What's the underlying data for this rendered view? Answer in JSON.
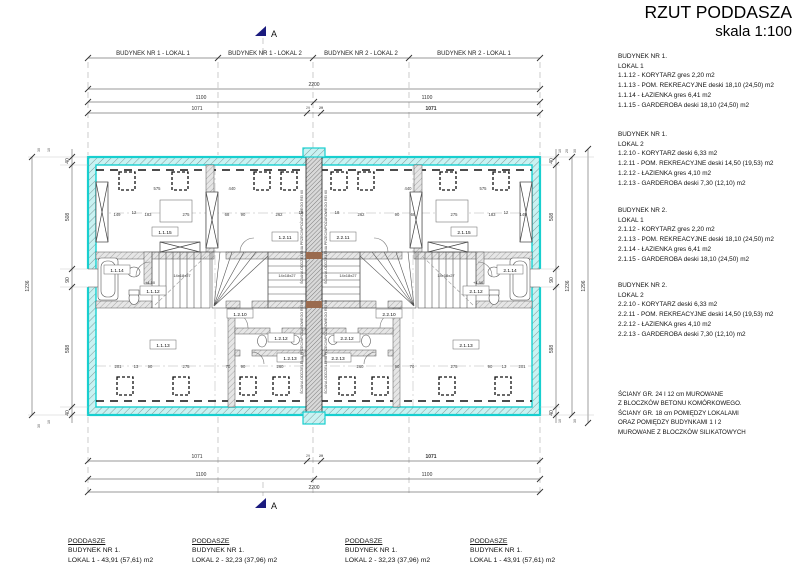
{
  "title": {
    "main": "RZUT PODDASZA",
    "scale": "skala 1:100"
  },
  "marker": {
    "letter": "A"
  },
  "axis": {
    "top_labels": [
      "BUDYNEK NR 1 - LOKAL 1",
      "BUDYNEK NR 1 - LOKAL 2",
      "BUDYNEK NR 2 - LOKAL 2",
      "BUDYNEK NR 2 - LOKAL 1"
    ],
    "total": "2200",
    "half": "1100",
    "segment": "1071",
    "gap": "29",
    "v_total": "1236",
    "v_outer": "1296",
    "v40": "40",
    "v508": "508",
    "v90": "90",
    "v598": "598",
    "s30": "30",
    "s10": "10",
    "s20": "20"
  },
  "plan": {
    "firewall": "ŚCIANA ODDZIELENIA PRZECIWPOŻAROWEGO REI 60",
    "stair": "14x18x27",
    "level": "+4,50",
    "rooms": [
      "1.1.15",
      "1.2.11",
      "1.1.14",
      "1.1.12",
      "1.1.13",
      "1.2.10",
      "1.2.12",
      "1.2.13",
      "2.2.11",
      "2.1.15",
      "2.1.14",
      "2.1.12",
      "2.1.13",
      "2.2.10",
      "2.2.12",
      "2.2.13"
    ],
    "nums": [
      "575",
      "440",
      "149",
      "12",
      "183",
      "275",
      "68",
      "90",
      "262",
      "18",
      "18",
      "262",
      "90",
      "68",
      "275",
      "183",
      "12",
      "149",
      "440",
      "575",
      "201",
      "13",
      "90",
      "275",
      "70",
      "90",
      "260",
      "260",
      "90",
      "70",
      "275",
      "90",
      "13",
      "201"
    ]
  },
  "legend": {
    "blocks": [
      {
        "building": "BUDYNEK NR 1.",
        "lokal": "LOKAL 1",
        "rows": [
          "1.1.12 - KORYTARZ gres 2,20 m2",
          "1.1.13 - POM. REKREACYJNE deski 18,10 (24,50) m2",
          "1.1.14 - ŁAZIENKA gres 6,41 m2",
          "1.1.15 - GARDEROBA deski 18,10 (24,50) m2"
        ]
      },
      {
        "building": "BUDYNEK NR 1.",
        "lokal": "LOKAL 2",
        "rows": [
          "1.2.10 - KORYTARZ deski 6,33 m2",
          "1.2.11 - POM. REKREACYJNE deski 14,50 (19,53) m2",
          "1.2.12 - ŁAZIENKA gres 4,10 m2",
          "1.2.13 - GARDEROBA deski 7,30 (12,10) m2"
        ]
      },
      {
        "building": "BUDYNEK NR 2.",
        "lokal": "LOKAL 1",
        "rows": [
          "2.1.12 - KORYTARZ gres 2,20 m2",
          "2.1.13 - POM. REKREACYJNE deski 18,10 (24,50) m2",
          "2.1.14 - ŁAZIENKA gres 6,41 m2",
          "2.1.15 - GARDEROBA deski 18,10 (24,50) m2"
        ]
      },
      {
        "building": "BUDYNEK NR 2.",
        "lokal": "LOKAL 2",
        "rows": [
          "2.2.10 - KORYTARZ deski 6,33 m2",
          "2.2.11 - POM. REKREACYJNE deski 14,50 (19,53) m2",
          "2.2.12 - ŁAZIENKA gres 4,10 m2",
          "2.2.13 - GARDEROBA deski 7,30 (12,10) m2"
        ]
      }
    ],
    "notes": [
      "ŚCIANY GR. 24 I 12 cm MUROWANE",
      "Z BLOCZKÓW BETONU KOMÓRKOWEGO.",
      "ŚCIANY GR. 18 cm POMIĘDZY LOKALAMI",
      "ORAZ POMIĘDZY BUDYNKAMI 1 I 2",
      "MUROWANE Z BLOCZKÓW SILIKATOWYCH"
    ]
  },
  "footer": {
    "blocks": [
      {
        "h": "PODDASZE",
        "b": "BUDYNEK NR 1.",
        "l": "LOKAL 1 - 43,91 (57,61) m2"
      },
      {
        "h": "PODDASZE",
        "b": "BUDYNEK NR 1.",
        "l": "LOKAL 2 - 32,23 (37,96) m2"
      },
      {
        "h": "PODDASZE",
        "b": "BUDYNEK NR 1.",
        "l": "LOKAL 2 - 32,23 (37,96) m2"
      },
      {
        "h": "PODDASZE",
        "b": "BUDYNEK NR 1.",
        "l": "LOKAL 1 - 43,91 (57,61) m2"
      }
    ]
  }
}
